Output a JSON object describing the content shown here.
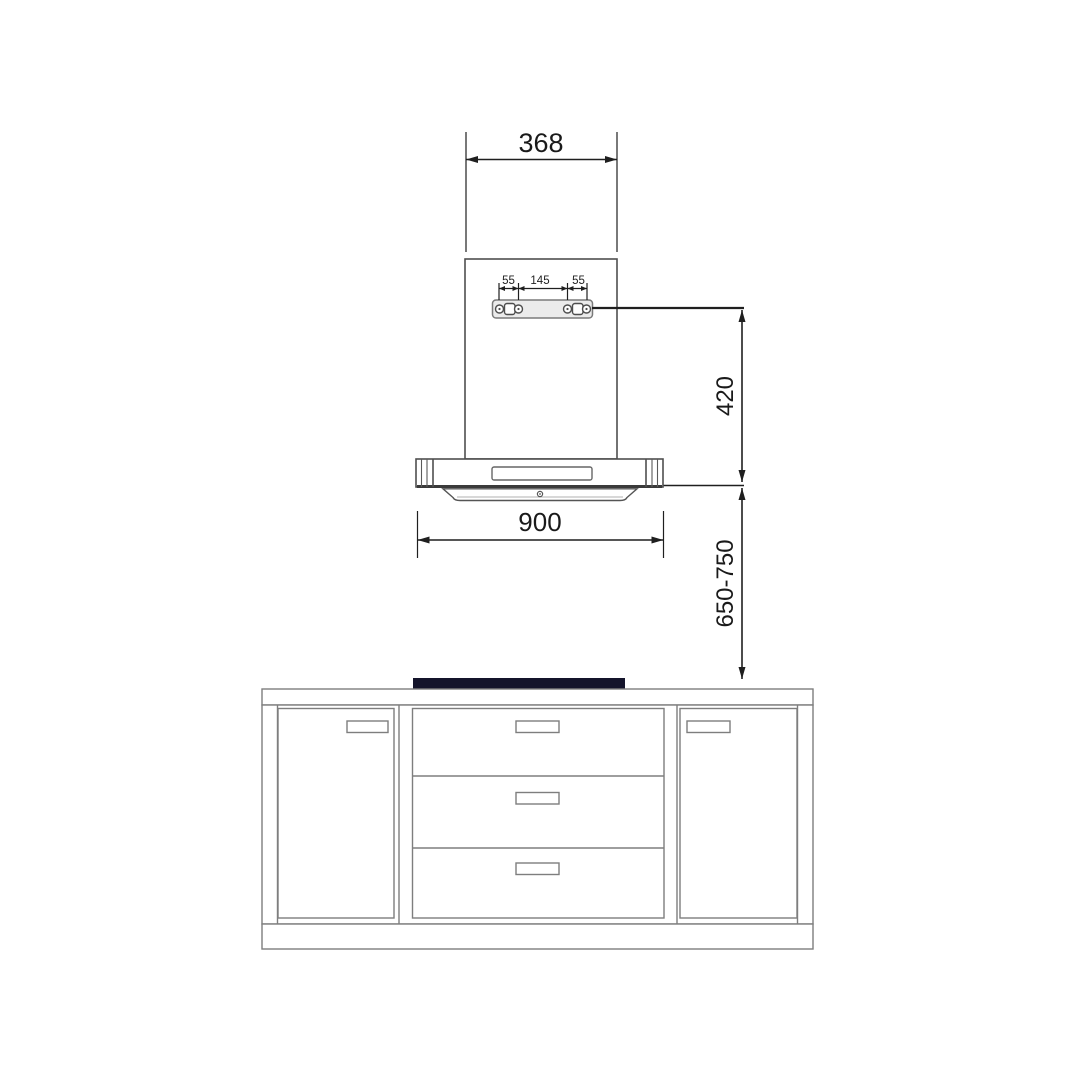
{
  "diagram": {
    "dimensions": {
      "duct_width": "368",
      "bracket_hole_left": "55",
      "bracket_hole_center": "145",
      "bracket_hole_right": "55",
      "bracket_to_hood_bottom": "420",
      "hood_width": "900",
      "hood_to_cooktop": "650-750"
    },
    "colors": {
      "dimension_line": "#1f1f1f",
      "product_line": "#4f4f4f",
      "cabinet_line": "#7e7e7e",
      "bracket_fill": "#ebebeb",
      "cooktop_fill": "#14142b",
      "background": "#ffffff"
    }
  }
}
